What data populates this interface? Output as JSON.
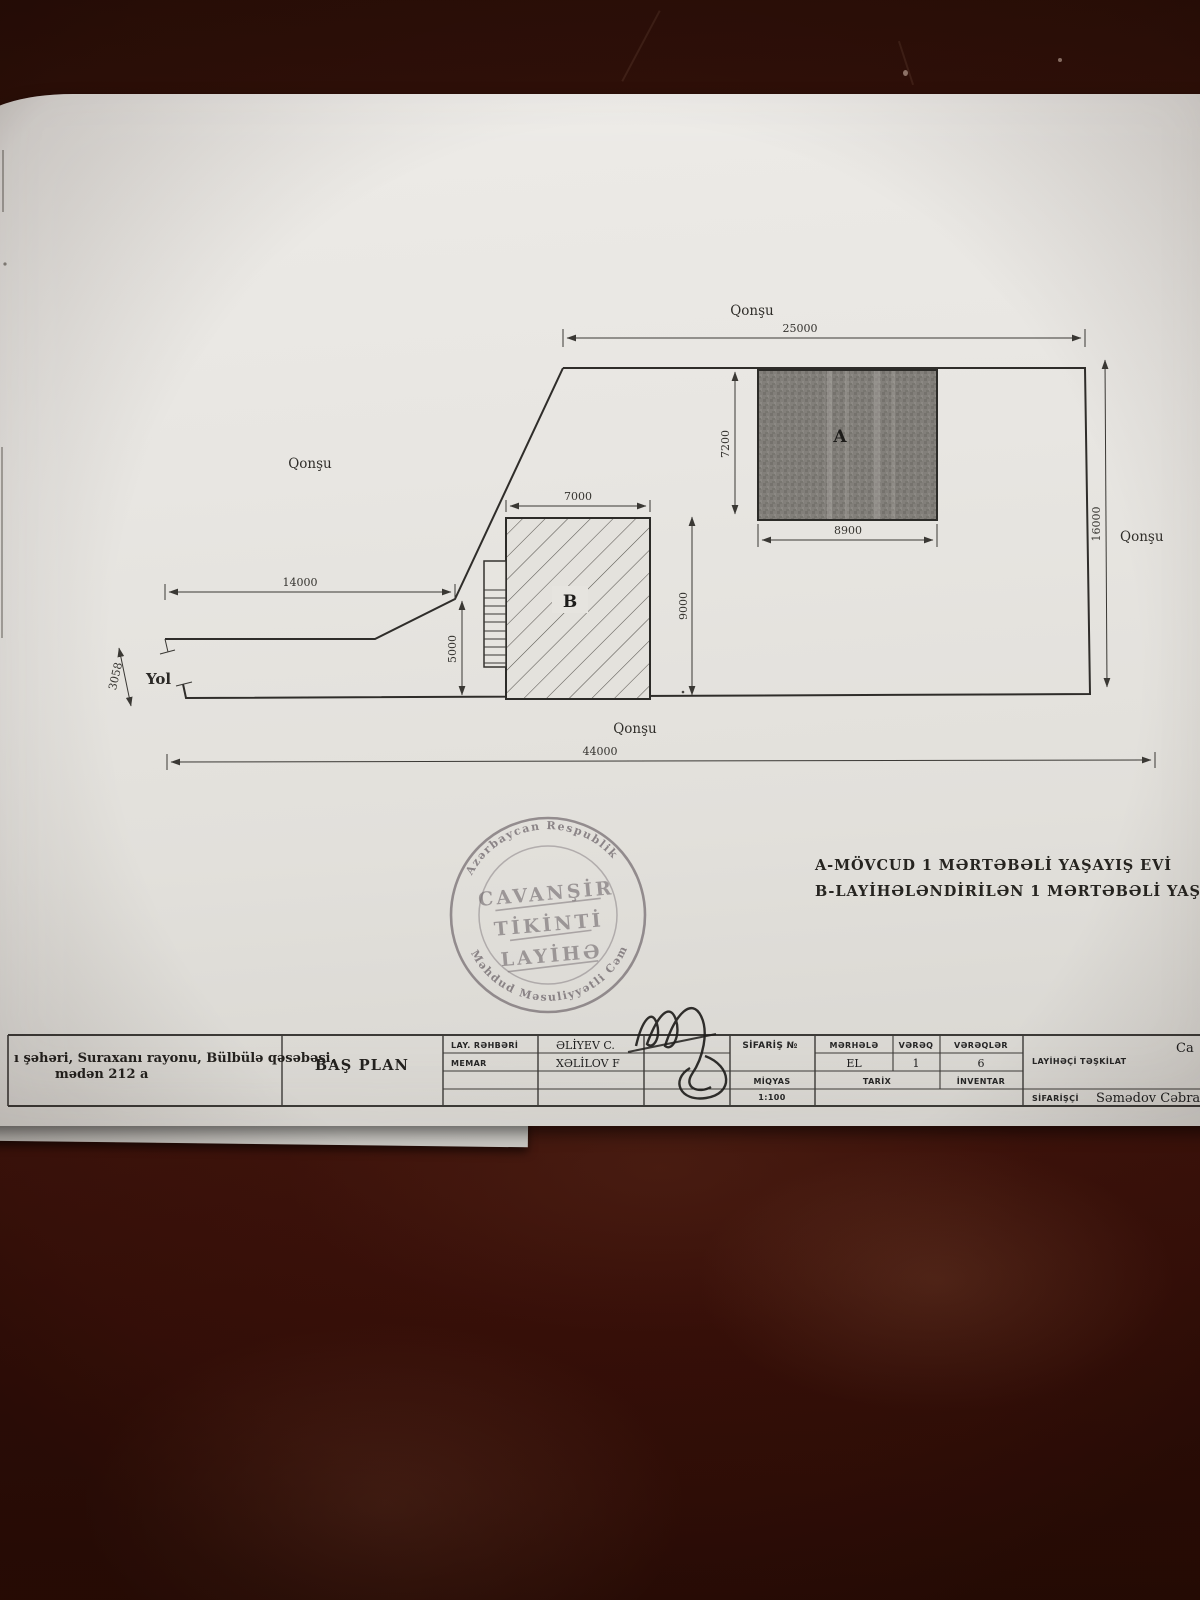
{
  "photo": {
    "table_color": "#3a130b",
    "paper_color": "#e8e6e2"
  },
  "plan": {
    "neighbor_top": "Qonşu",
    "neighbor_left": "Qonşu",
    "neighbor_right": "Qonşu",
    "neighbor_bottom": "Qonşu",
    "road_label": "Yol",
    "building_a_label": "A",
    "building_b_label": "B",
    "dim_site_top": "25000",
    "dim_site_bottom": "44000",
    "dim_site_right": "16000",
    "dim_site_left": "14000",
    "dim_a_width": "8900",
    "dim_a_height": "7200",
    "dim_b_width": "7000",
    "dim_b_height": "9000",
    "dim_setback": "5000",
    "dim_road": "3058"
  },
  "legend": {
    "line_a": "A-MÖVCUD 1 MƏRTƏBƏLİ  YAŞAYIŞ EVİ",
    "line_b": "B-LAYİHƏLƏNDİRİLƏN 1 MƏRTƏBƏLİ  YAŞAYIŞ EVİ"
  },
  "stamp": {
    "ring_top": "Azərbaycan  Respublik",
    "ring_bottom": "Məhdud Məsuliyyətli Cəmiyyə",
    "line1": "CAVANŞİR",
    "line2": "TİKİNTİ",
    "line3": "LAYİHƏ"
  },
  "title_block": {
    "address_line1": "ı şəhəri, Suraxanı rayonu, Bülbülə qəsəbəsi,",
    "address_line2": "mədən 212 a",
    "sheet_title": "BAŞ PLAN",
    "role1_label": "LAY. RƏHBƏRİ",
    "role1_name": "ƏLİYEV C.",
    "role2_label": "MEMAR",
    "role2_name": "XƏLİLOV F",
    "order_label": "SİFARİŞ №",
    "scale_label": "MİQYAS",
    "scale_value": "1:100",
    "stage_label": "MƏRHƏLƏ",
    "stage_value": "EL",
    "sheet_label": "VƏRƏQ",
    "sheet_value": "1",
    "sheets_label": "VƏRƏQLƏR",
    "sheets_value": "6",
    "date_label": "TARİX",
    "inventory_label": "İNVENTAR",
    "designer_label": "LAYİHƏÇİ TƏŞKİLAT",
    "designer_value": "Ca",
    "client_label": "SİFARİŞÇİ",
    "client_value": "Səmədov Cəbrayıl"
  }
}
